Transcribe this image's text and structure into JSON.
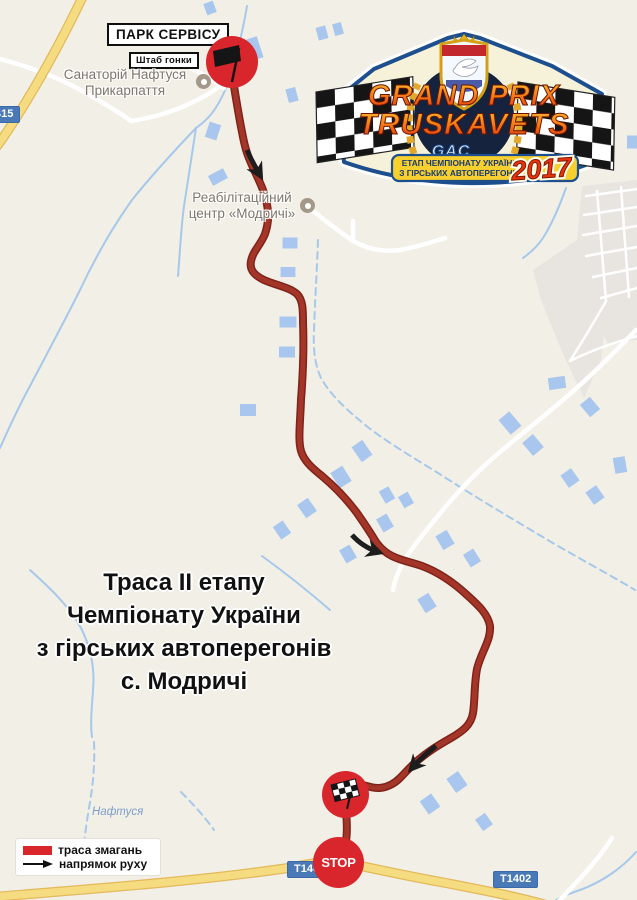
{
  "map": {
    "colors": {
      "bg": "#f2efe6",
      "building": "#a9c7ee",
      "urban": "#e8e5e0",
      "road-white": "#ffffff",
      "road-yellow": "#f6dc81",
      "road-yellow-casing": "#e2b95b",
      "stream": "#a6c8ea",
      "route": "#a33628",
      "route-casing": "#7f2219",
      "arrow": "#1d1d1d",
      "marker-red": "#d8262c",
      "chip-blue": "#4a79b8",
      "label-gray": "#7d766c"
    },
    "urban_areas": [
      "M582 186 L637 180 L637 340 L608 344 L586 302 L577 240 Z",
      "M577 240 L608 300 L601 360 L584 398 L562 352 L541 300 L533 270 Z"
    ],
    "yellow_roads": [
      "M84 -6 C64 36 40 80 16 118 C9 129 2 140 -6 150",
      "M-6 897 C90 889 200 881 288 868 C314 863 330 860 342 862 C362 866 396 874 446 883 C492 892 518 897 550 906"
    ],
    "white_roads": [
      "M636 330 C616 351 596 371 571 393 C546 415 516 438 493 458 C471 477 449 502 433 522 C421 537 411 549 405 559 C399 569 395 579 393 590",
      "M309 207 C323 220 339 231 353 241 C367 249 383 252 399 250 C413 248 429 243 445 238",
      "M353 241 L353 221",
      "M-4 58 C28 66 58 77 86 93 C103 103 119 112 131 121",
      "M131 121 C152 118 172 112 191 103 C202 98 212 92 220 86",
      "M168 60 C190 66 208 76 224 88",
      "M612 838 C599 859 579 880 558 902"
    ],
    "street_grid": [
      "M586 196 L637 189",
      "M584 215 L637 207",
      "M583 235 L637 226",
      "M586 256 L637 247",
      "M593 277 L637 268",
      "M601 298 L637 288",
      "M597 191 L606 301",
      "M621 187 L629 297",
      "M605 303 C594 322 582 342 570 361",
      "M570 361 C592 350 616 342 637 336"
    ],
    "streams": [
      "M247 6 C243 30 236 60 226 88 C216 112 206 121 196 128",
      "M196 128 C175 150 152 175 132 200 C112 228 95 258 80 290 C65 320 48 352 30 386 C18 408 8 430 0 448",
      "M196 128 C192 155 188 180 184 206 C181 228 180 252 178 276",
      "M262 556 C284 572 307 590 330 610",
      "M30 570 C50 588 69 606 81 628 C91 648 95 668 93 690 C92 707 90 722 92 737",
      "M566 188 C560 205 553 222 543 238 C537 247 530 253 523 258",
      "M636 852 C622 868 602 882 580 890 C571 893 563 896 556 900"
    ],
    "streams_dashed": [
      "M318 240 C317 270 315 300 314 330 C313 350 315 365 321 378 C331 396 349 412 369 428 C391 445 421 462 449 480 C477 498 511 518 541 536 C571 554 605 572 635 590",
      "M94 742 C95 764 93 786 89 808 C86 826 84 841 83 856",
      "M181 792 C193 804 204 816 214 830"
    ],
    "buildings": [
      [
        253,
        49,
        15,
        22,
        -18
      ],
      [
        292,
        95,
        10,
        14,
        -15
      ],
      [
        213,
        131,
        12,
        16,
        18
      ],
      [
        218,
        177,
        17,
        11,
        -28
      ],
      [
        322,
        33,
        10,
        13,
        -15
      ],
      [
        338,
        29,
        9,
        12,
        -15
      ],
      [
        210,
        8,
        10,
        12,
        -20
      ],
      [
        577,
        93,
        11,
        14,
        -20
      ],
      [
        632,
        142,
        10,
        13,
        0
      ],
      [
        290,
        243,
        15,
        11,
        0
      ],
      [
        288,
        272,
        15,
        10,
        0
      ],
      [
        288,
        322,
        17,
        11,
        0
      ],
      [
        287,
        352,
        16,
        11,
        0
      ],
      [
        248,
        410,
        16,
        12,
        0
      ],
      [
        362,
        451,
        13,
        18,
        -35
      ],
      [
        341,
        477,
        14,
        18,
        -32
      ],
      [
        307,
        508,
        13,
        16,
        -35
      ],
      [
        282,
        530,
        12,
        15,
        -35
      ],
      [
        387,
        495,
        11,
        14,
        -30
      ],
      [
        406,
        500,
        11,
        13,
        -30
      ],
      [
        385,
        523,
        12,
        15,
        -30
      ],
      [
        348,
        554,
        12,
        15,
        -30
      ],
      [
        445,
        540,
        13,
        16,
        -30
      ],
      [
        472,
        558,
        12,
        15,
        -32
      ],
      [
        427,
        603,
        13,
        16,
        -32
      ],
      [
        557,
        383,
        17,
        12,
        -8
      ],
      [
        510,
        423,
        14,
        19,
        -40
      ],
      [
        533,
        445,
        14,
        17,
        -40
      ],
      [
        590,
        407,
        13,
        16,
        -40
      ],
      [
        620,
        465,
        12,
        16,
        -10
      ],
      [
        570,
        478,
        13,
        15,
        -35
      ],
      [
        595,
        495,
        13,
        15,
        -35
      ],
      [
        457,
        782,
        14,
        17,
        -35
      ],
      [
        430,
        804,
        14,
        16,
        -35
      ],
      [
        484,
        822,
        12,
        14,
        -35
      ]
    ],
    "route": {
      "path": "M232 74 C235 92 238 112 242 132 C245 148 247 154 251 163 C257 177 263 187 266 200 C269 212 269 222 265 234 C260 246 253 251 251 261 C249 271 256 276 264 280 C275 285 289 287 297 294 C303 300 303 310 303 322 C304 347 303 374 301 400 C300 426 298 440 301 451 C304 461 312 468 322 476 C335 487 346 498 357 513 C364 523 370 532 376 542 C381 549 386 553 392 556 C402 561 411 562 422 566 C438 572 454 583 467 595 C478 605 488 614 490 626 C491 641 481 652 477 669 C474 685 475 701 473 713 C471 725 463 731 451 738 C437 746 429 751 417 761 C410 767 405 773 400 778 C394 784 386 788 378 788 C369 788 362 783 355 785 C349 787 346 791 345 796 C346 813 348 828 346 841 C344 852 341 858 339 863",
      "arrows": [
        "M247 150 C251 160 256 168 260 175",
        "M352 535 C360 544 369 549 378 552",
        "M436 746 C428 752 420 759 412 768"
      ]
    }
  },
  "labels": {
    "park_service": "ПАРК СЕРВІСУ",
    "race_hq": "Штаб гонки",
    "sanatorium": "Санаторій Нафтуся\nПрикарпаття",
    "rehab_center": "Реабілітаційний\nцентр «Модричі»",
    "river": "Нафтуся",
    "road_415": "415",
    "road_t1402_a": "T1402",
    "road_t1402_b": "T1402",
    "stop": "STOP"
  },
  "title": {
    "line1": "Траса II етапу",
    "line2": "Чемпіонату України",
    "line3": "з гірських автоперегонів",
    "line4": "с. Модричі"
  },
  "legend": {
    "route_label": "траса змагань",
    "direction_label": "напрямок руху"
  },
  "plate": {
    "title_top": "GRAND PRIX",
    "title_bottom": "TRUSKAVETS",
    "federation": "GAC",
    "subtitle_line1": "ЕТАП ЧЕМПІОНАТУ УКРАЇНИ",
    "subtitle_line2": "З ГІРСЬКИХ АВТОПЕРЕГОНІВ",
    "year": "2017"
  }
}
